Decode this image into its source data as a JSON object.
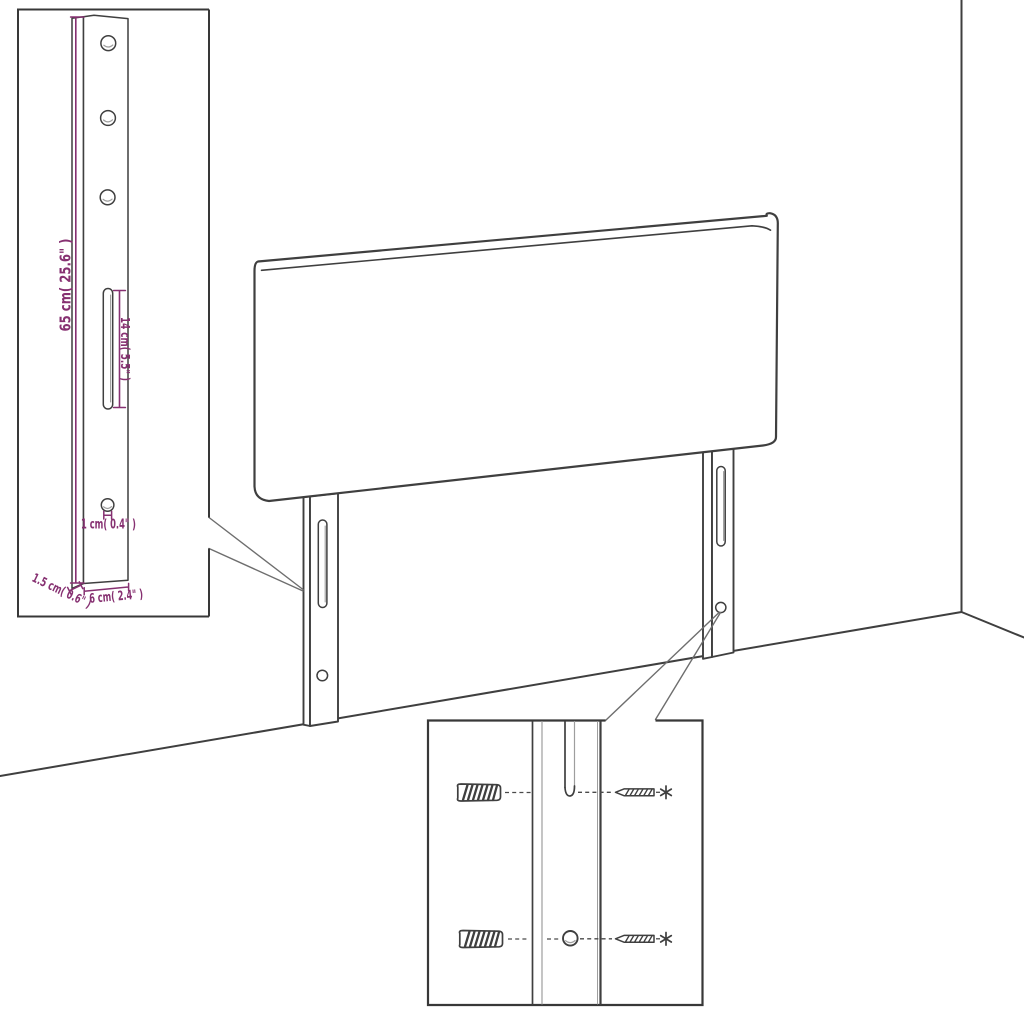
{
  "colors": {
    "line": "#3f3f3f",
    "line_light": "#9e9e9e",
    "dimension": "#863071",
    "border": "#383838",
    "callout": "#6e6e6e",
    "background": "#ffffff"
  },
  "bracket_inset": {
    "height_label": "65 cm( 25.6\" )",
    "slot_label": "14 cm( 5.5\" )",
    "hole_label": "1 cm( 0.4\" )",
    "thickness_label": "1.5 cm( 0.6\" )",
    "width_label": "6 cm( 2.4\" )"
  }
}
